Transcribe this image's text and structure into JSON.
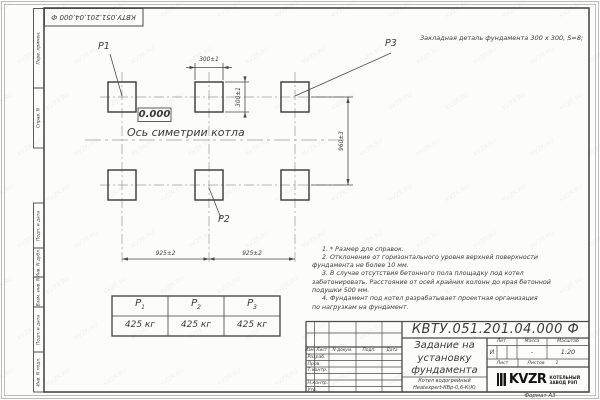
{
  "watermark": {
    "text": "KVZR.RU"
  },
  "doc_number": "КВТУ.051.201.04.000  Ф",
  "top_note": "Закладная деталь фундамента  300 х 300,  S=8;",
  "plan": {
    "labels": {
      "p1": "P1",
      "p2": "P2",
      "p3": "P3"
    },
    "elevation": "0.000",
    "axis_label": "Ось симетрии котла",
    "dims": {
      "plate_width": "300±1",
      "plate_height": "300±1",
      "row_spacing": "960±3",
      "col_spacing_left": "925±2",
      "col_spacing_right": "925±2"
    }
  },
  "load_table": {
    "columns": [
      {
        "label": "P",
        "sub": "1",
        "value": "425 кг"
      },
      {
        "label": "P",
        "sub": "2",
        "value": "425 кг"
      },
      {
        "label": "P",
        "sub": "3",
        "value": "425 кг"
      }
    ]
  },
  "notes": {
    "lines": [
      "1. * Размер для справок.",
      "2. Отклонение от горизонтального уровня верхней поверхности",
      "фундамента не более 10 мм.",
      "3. В случае отсутствия бетонного пола площадку под котел",
      "забетонировать. Расстояние от осей крайних колонн до края бетонной",
      "подушки 500 мм.",
      "4. Фундамент под котел разрабатывает проектная организация",
      "по нагрузкам на фундамент."
    ]
  },
  "title_block": {
    "title_lines": [
      "Задание на",
      "установку",
      "фундамента"
    ],
    "product_lines": [
      "Котел водогрейный",
      "Heatexpert-КВр-0,6-К(К)"
    ],
    "rev_headers": [
      "Изм.",
      "Лист",
      "N докум.",
      "Подп.",
      "Дата"
    ],
    "sign_rows": [
      "Разраб.",
      "Пров.",
      "Т.контр.",
      "Н.контр.",
      "Утв."
    ],
    "lit_label": "Лит.",
    "lit_value": "И",
    "mass_label": "Масса",
    "mass_value": "-",
    "scale_label": "Масштаб",
    "scale_value": "1:20",
    "sheet_label": "Лист",
    "sheets_label": "Листов",
    "sheets_value": "1",
    "company": {
      "logo": "KVZR",
      "name_lines": [
        "КОТЕЛЬНЫЙ",
        "ЗАВОД РЭП"
      ]
    },
    "format_label": "Формат А3"
  },
  "side_labels": [
    "Перв. примен.",
    "Справ. N",
    "Подп. и дата",
    "Инв. N дубл.",
    "Взам. инв. N",
    "Подп. и дата",
    "Инв. N подл."
  ]
}
